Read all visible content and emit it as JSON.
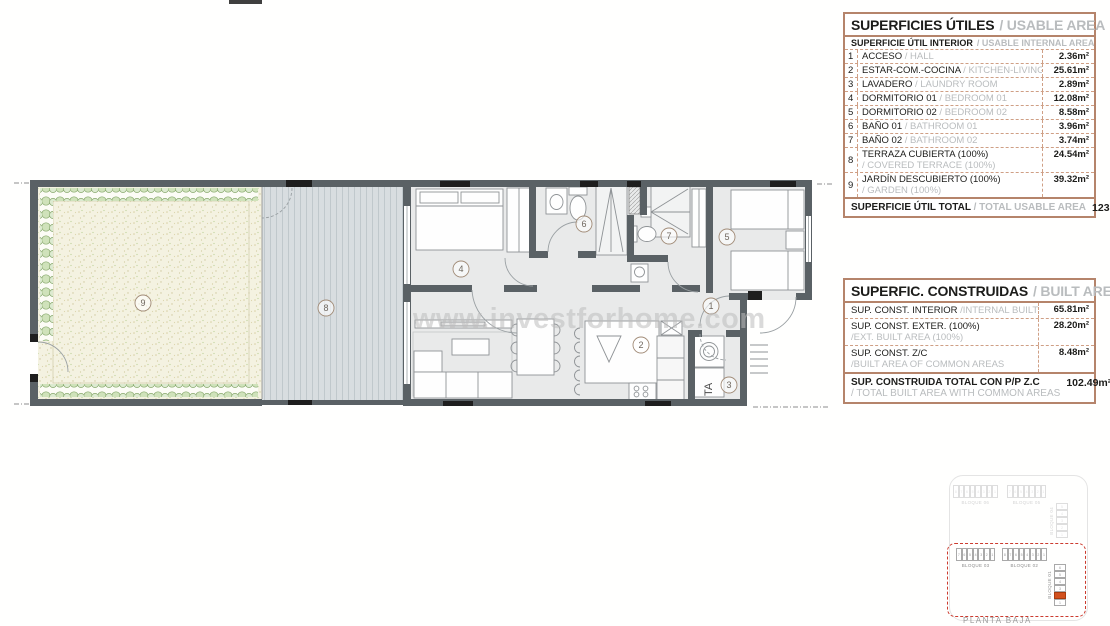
{
  "plan": {
    "watermark": "www.investforhome.com",
    "appliance_label": "TA",
    "room_labels": [
      "9",
      "8",
      "4",
      "6",
      "7",
      "5",
      "1",
      "2",
      "3"
    ]
  },
  "usable": {
    "title_es": "SUPERFICIES ÚTILES",
    "title_en": "/ USABLE AREA",
    "sub_es": "SUPERFICIE ÚTIL INTERIOR",
    "sub_en": "/ USABLE INTERNAL AREA",
    "rows": [
      {
        "num": "1",
        "es": "ACCESO",
        "en": "/ HALL",
        "value": "2.36m²",
        "two": false
      },
      {
        "num": "2",
        "es": "ESTAR-COM.-COCINA",
        "en": "/ KITCHEN-LIVING",
        "value": "25.61m²",
        "two": false
      },
      {
        "num": "3",
        "es": "LAVADERO",
        "en": "/ LAUNDRY ROOM",
        "value": "2.89m²",
        "two": false
      },
      {
        "num": "4",
        "es": "DORMITORIO 01",
        "en": "/ BEDROOM 01",
        "value": "12.08m²",
        "two": false
      },
      {
        "num": "5",
        "es": "DORMITORIO 02",
        "en": "/ BEDROOM 02",
        "value": "8.58m²",
        "two": false
      },
      {
        "num": "6",
        "es": "BAÑO 01",
        "en": "/ BATHROOM 01",
        "value": "3.96m²",
        "two": false
      },
      {
        "num": "7",
        "es": "BAÑO 02",
        "en": "/ BATHROOM 02",
        "value": "3.74m²",
        "two": false
      },
      {
        "num": "8",
        "es": "TERRAZA CUBIERTA (100%)",
        "en": "/ COVERED TERRACE (100%)",
        "value": "24.54m²",
        "two": true
      },
      {
        "num": "9",
        "es": "JARDÍN DESCUBIERTO (100%)",
        "en": "/ GARDEN (100%)",
        "value": "39.32m²",
        "two": true
      }
    ],
    "total_es": "SUPERFICIE ÚTIL TOTAL",
    "total_en": "/ TOTAL USABLE AREA",
    "total_value": "123.08m²"
  },
  "built": {
    "title_es": "SUPERFIC. CONSTRUIDAS",
    "title_en": "/ BUILT AREA",
    "rows": [
      {
        "es": "SUP. CONST. INTERIOR",
        "en": "/INTERNAL BUILT AREA",
        "value": "65.81m²",
        "two": false
      },
      {
        "es": "SUP. CONST. EXTER. (100%)",
        "en": "/EXT. BUILT AREA (100%)",
        "value": "28.20m²",
        "two": true
      },
      {
        "es": "SUP. CONST. Z/C",
        "en": "/BUILT AREA OF COMMON AREAS",
        "value": "8.48m²",
        "two": true
      }
    ],
    "total_es": "SUP. CONSTRUIDA TOTAL CON P/P Z.C",
    "total_en": "/ TOTAL BUILT AREA WITH COMMON AREAS",
    "total_value": "102.49m²"
  },
  "keyplan": {
    "blocks": [
      {
        "label": "BLOQUE 06",
        "units": 8,
        "dir": "h",
        "faint": true
      },
      {
        "label": "BLOQUE 05",
        "units": 7,
        "dir": "h",
        "faint": true
      },
      {
        "label": "BLOQUE 04",
        "units": 5,
        "dir": "v",
        "faint": true
      },
      {
        "label": "BLOQUE 03",
        "units": 7,
        "dir": "h"
      },
      {
        "label": "BLOQUE 02",
        "units": 8,
        "dir": "h"
      },
      {
        "label": "BLOQUE 01",
        "units": 6,
        "dir": "v",
        "highlight": 5
      }
    ],
    "floor_label": "PLANTA BAJA",
    "highlight_color": "#d2511e"
  },
  "colors": {
    "wall": "#5a6165",
    "table_border": "#b5846b",
    "table_dash": "#cf9f85",
    "hedge_green": "#88a96d",
    "deck": "#d8dde0"
  }
}
